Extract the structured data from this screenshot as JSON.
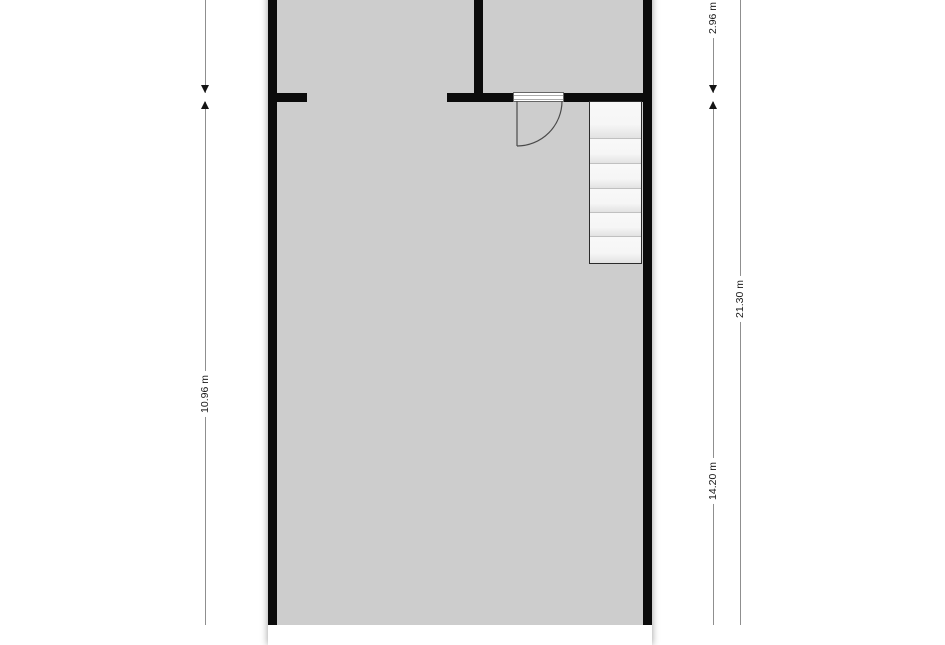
{
  "drawing": {
    "type": "floor-plan",
    "dimension_labels": {
      "left_height": "10.96 m",
      "right_top": "2.96 m",
      "right_lower": "14.20 m",
      "right_total": "21.30 m"
    },
    "staircase": {
      "treads": 6
    },
    "colors": {
      "background": "#ffffff",
      "floor": "#cdcdcd",
      "wall": "#0b0b0b",
      "stair_fill": "#f6f6f6",
      "stair_divider": "#c0c0c0",
      "dimension_line": "#8f8f8f",
      "dimension_text": "#1a1a1a"
    }
  }
}
